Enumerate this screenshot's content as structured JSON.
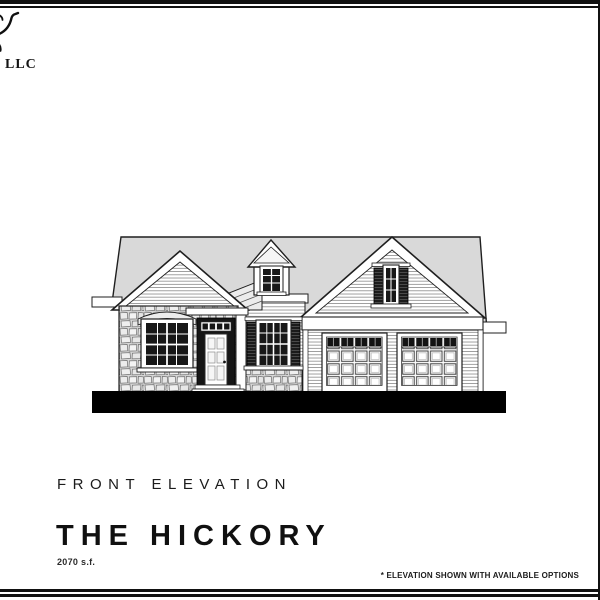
{
  "logo": {
    "suffix_text": "LLC",
    "mark": "script-flourish-cropped-at-left-edge"
  },
  "titles": {
    "view_label": "FRONT ELEVATION",
    "plan_name": "THE HICKORY",
    "area": "2070 s.f."
  },
  "footnote": {
    "text": "* ELEVATION SHOWN WITH AVAILABLE OPTIONS"
  },
  "drawing": {
    "type": "architectural-front-elevation",
    "elements": [
      "main roof",
      "left stone-veneer gable with arched-lintel window",
      "gabled entry dormer with window",
      "front entry door with transom",
      "shuttered window with stone wainscot",
      "entry porch roof with post",
      "right garage gable with shuttered window",
      "two paneled garage doors with window top rows",
      "black ground line"
    ],
    "colors": {
      "roof_gray": "#d9d9d9",
      "line": "#1f1f1f",
      "stone_base": "#d6d6d6",
      "glass": "#181818",
      "ground": "#000000",
      "wall_white": "#ffffff"
    }
  }
}
